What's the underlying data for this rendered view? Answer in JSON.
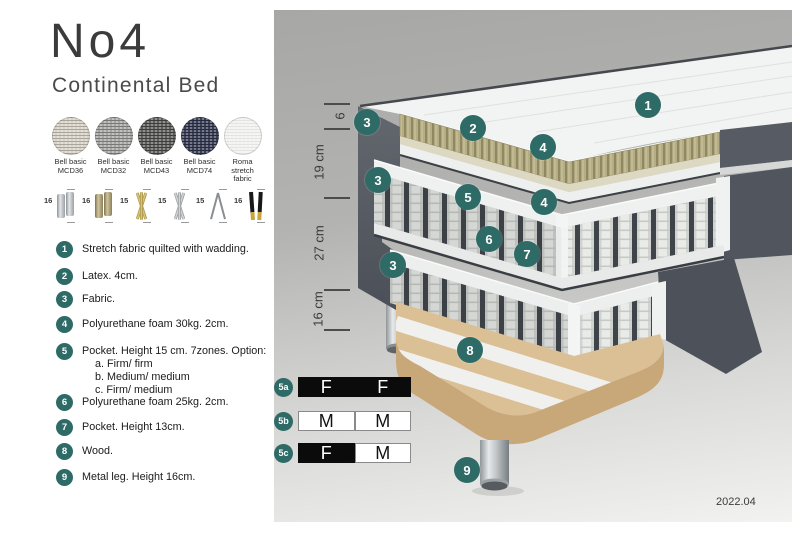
{
  "header": {
    "title": "No4",
    "subtitle": "Continental Bed"
  },
  "fabrics": [
    {
      "name_line1": "Bell basic",
      "name_line2": "MCD36",
      "color": "#d7d3c8",
      "texture": "#a9a59a"
    },
    {
      "name_line1": "Bell basic",
      "name_line2": "MCD32",
      "color": "#a6a6a4",
      "texture": "#787876"
    },
    {
      "name_line1": "Bell basic",
      "name_line2": "MCD43",
      "color": "#60615f",
      "texture": "#3d3e3c"
    },
    {
      "name_line1": "Bell basic",
      "name_line2": "MCD74",
      "color": "#3c4157",
      "texture": "#252a3d"
    },
    {
      "name_line1": "Roma",
      "name_line2": "stretch fabric",
      "color": "#f2f2f0",
      "texture": "#e4e4e2"
    }
  ],
  "legs": [
    {
      "height": "16",
      "type": "cylinder-silver"
    },
    {
      "height": "16",
      "type": "cylinder-brass"
    },
    {
      "height": "15",
      "type": "twist-gold"
    },
    {
      "height": "15",
      "type": "twist-silver"
    },
    {
      "height": "15",
      "type": "hairpin"
    },
    {
      "height": "16",
      "type": "block-black-gold"
    }
  ],
  "parts": [
    {
      "num": "1",
      "text": "Stretch fabric quilted with wadding."
    },
    {
      "num": "2",
      "text": "Latex. 4cm."
    },
    {
      "num": "3",
      "text": "Fabric."
    },
    {
      "num": "4",
      "text": "Polyurethane foam 30kg. 2cm."
    },
    {
      "num": "5",
      "text": "Pocket. Height 15 cm. 7zones. Option:",
      "sub": [
        "a. Firm/ firm",
        "b. Medium/ medium",
        "c. Firm/ medium"
      ]
    },
    {
      "num": "6",
      "text": "Polyurethane foam 25kg. 2cm."
    },
    {
      "num": "7",
      "text": "Pocket. Height 13cm."
    },
    {
      "num": "8",
      "text": "Wood."
    },
    {
      "num": "9",
      "text": "Metal leg. Height 16cm."
    }
  ],
  "diagram": {
    "dimensions": [
      "6",
      "19 cm",
      "27 cm",
      "16 cm"
    ],
    "callouts": [
      "1",
      "2",
      "3",
      "4",
      "3",
      "5",
      "4",
      "6",
      "7",
      "3",
      "8",
      "9"
    ],
    "firmness_options": [
      {
        "id": "5a",
        "cells": [
          {
            "value": "F",
            "variant": "dark"
          },
          {
            "value": "F",
            "variant": "dark"
          }
        ]
      },
      {
        "id": "5b",
        "cells": [
          {
            "value": "M",
            "variant": "light"
          },
          {
            "value": "M",
            "variant": "light"
          }
        ]
      },
      {
        "id": "5c",
        "cells": [
          {
            "value": "F",
            "variant": "dark"
          },
          {
            "value": "M",
            "variant": "light"
          }
        ]
      }
    ],
    "version": "2022.04",
    "badge_color": "#2e6b67"
  }
}
